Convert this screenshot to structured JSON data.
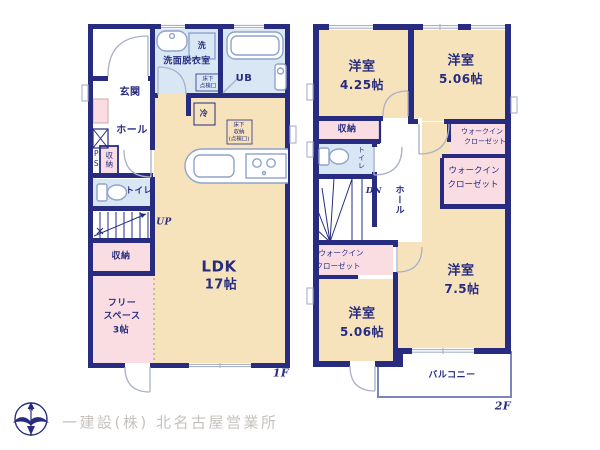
{
  "floor_1f": {
    "floor_label": "1F",
    "genkan": "玄関",
    "hall": "ホール",
    "ps": "PS",
    "shuno_hall": "収納",
    "toilet": "トイレ",
    "stairs_up": "UP",
    "shuno_stair": "収納",
    "free_space_l1": "フリー",
    "free_space_l2": "スペース",
    "free_space_l3": "3帖",
    "ldk": "LDK",
    "ldk_size": "17帖",
    "senmen": "洗面脱衣室",
    "laundry": "洗",
    "ub": "UB",
    "fridge": "冷",
    "hatch_l1": "床下",
    "hatch_l2": "点検口",
    "hatch2_l1": "床下",
    "hatch2_l2": "収納",
    "hatch2_l3": "(点検口)"
  },
  "floor_2f": {
    "floor_label": "2F",
    "room_425": "洋室",
    "room_425_size": "4.25帖",
    "room_506_top": "洋室",
    "room_506_top_size": "5.06帖",
    "room_75": "洋室",
    "room_75_size": "7.5帖",
    "room_506_btm": "洋室",
    "room_506_btm_size": "5.06帖",
    "shuno": "収納",
    "toilet": "トイレ",
    "stairs_dn": "DN",
    "hall": "ホール",
    "wic1_l1": "ウォークイン",
    "wic1_l2": "クローゼット",
    "wic2_l1": "ウォークイン",
    "wic2_l2": "クローゼット",
    "wic3_l1": "ウォークイン",
    "wic3_l2": "クローゼット",
    "balcony": "バルコニー"
  },
  "footer": {
    "company": "一建設(株) 北名古屋営業所",
    "compass_n": "N"
  },
  "colors": {
    "wall": "#272c80",
    "cream": "#f6e3bc",
    "pink": "#f9dde2",
    "blue": "#d9e7f5",
    "fixture": "#8fa3cc",
    "door": "#a9b1c6",
    "text": "#272c80",
    "footer": "#c6c1bd",
    "dotted": "#b3a38e"
  }
}
